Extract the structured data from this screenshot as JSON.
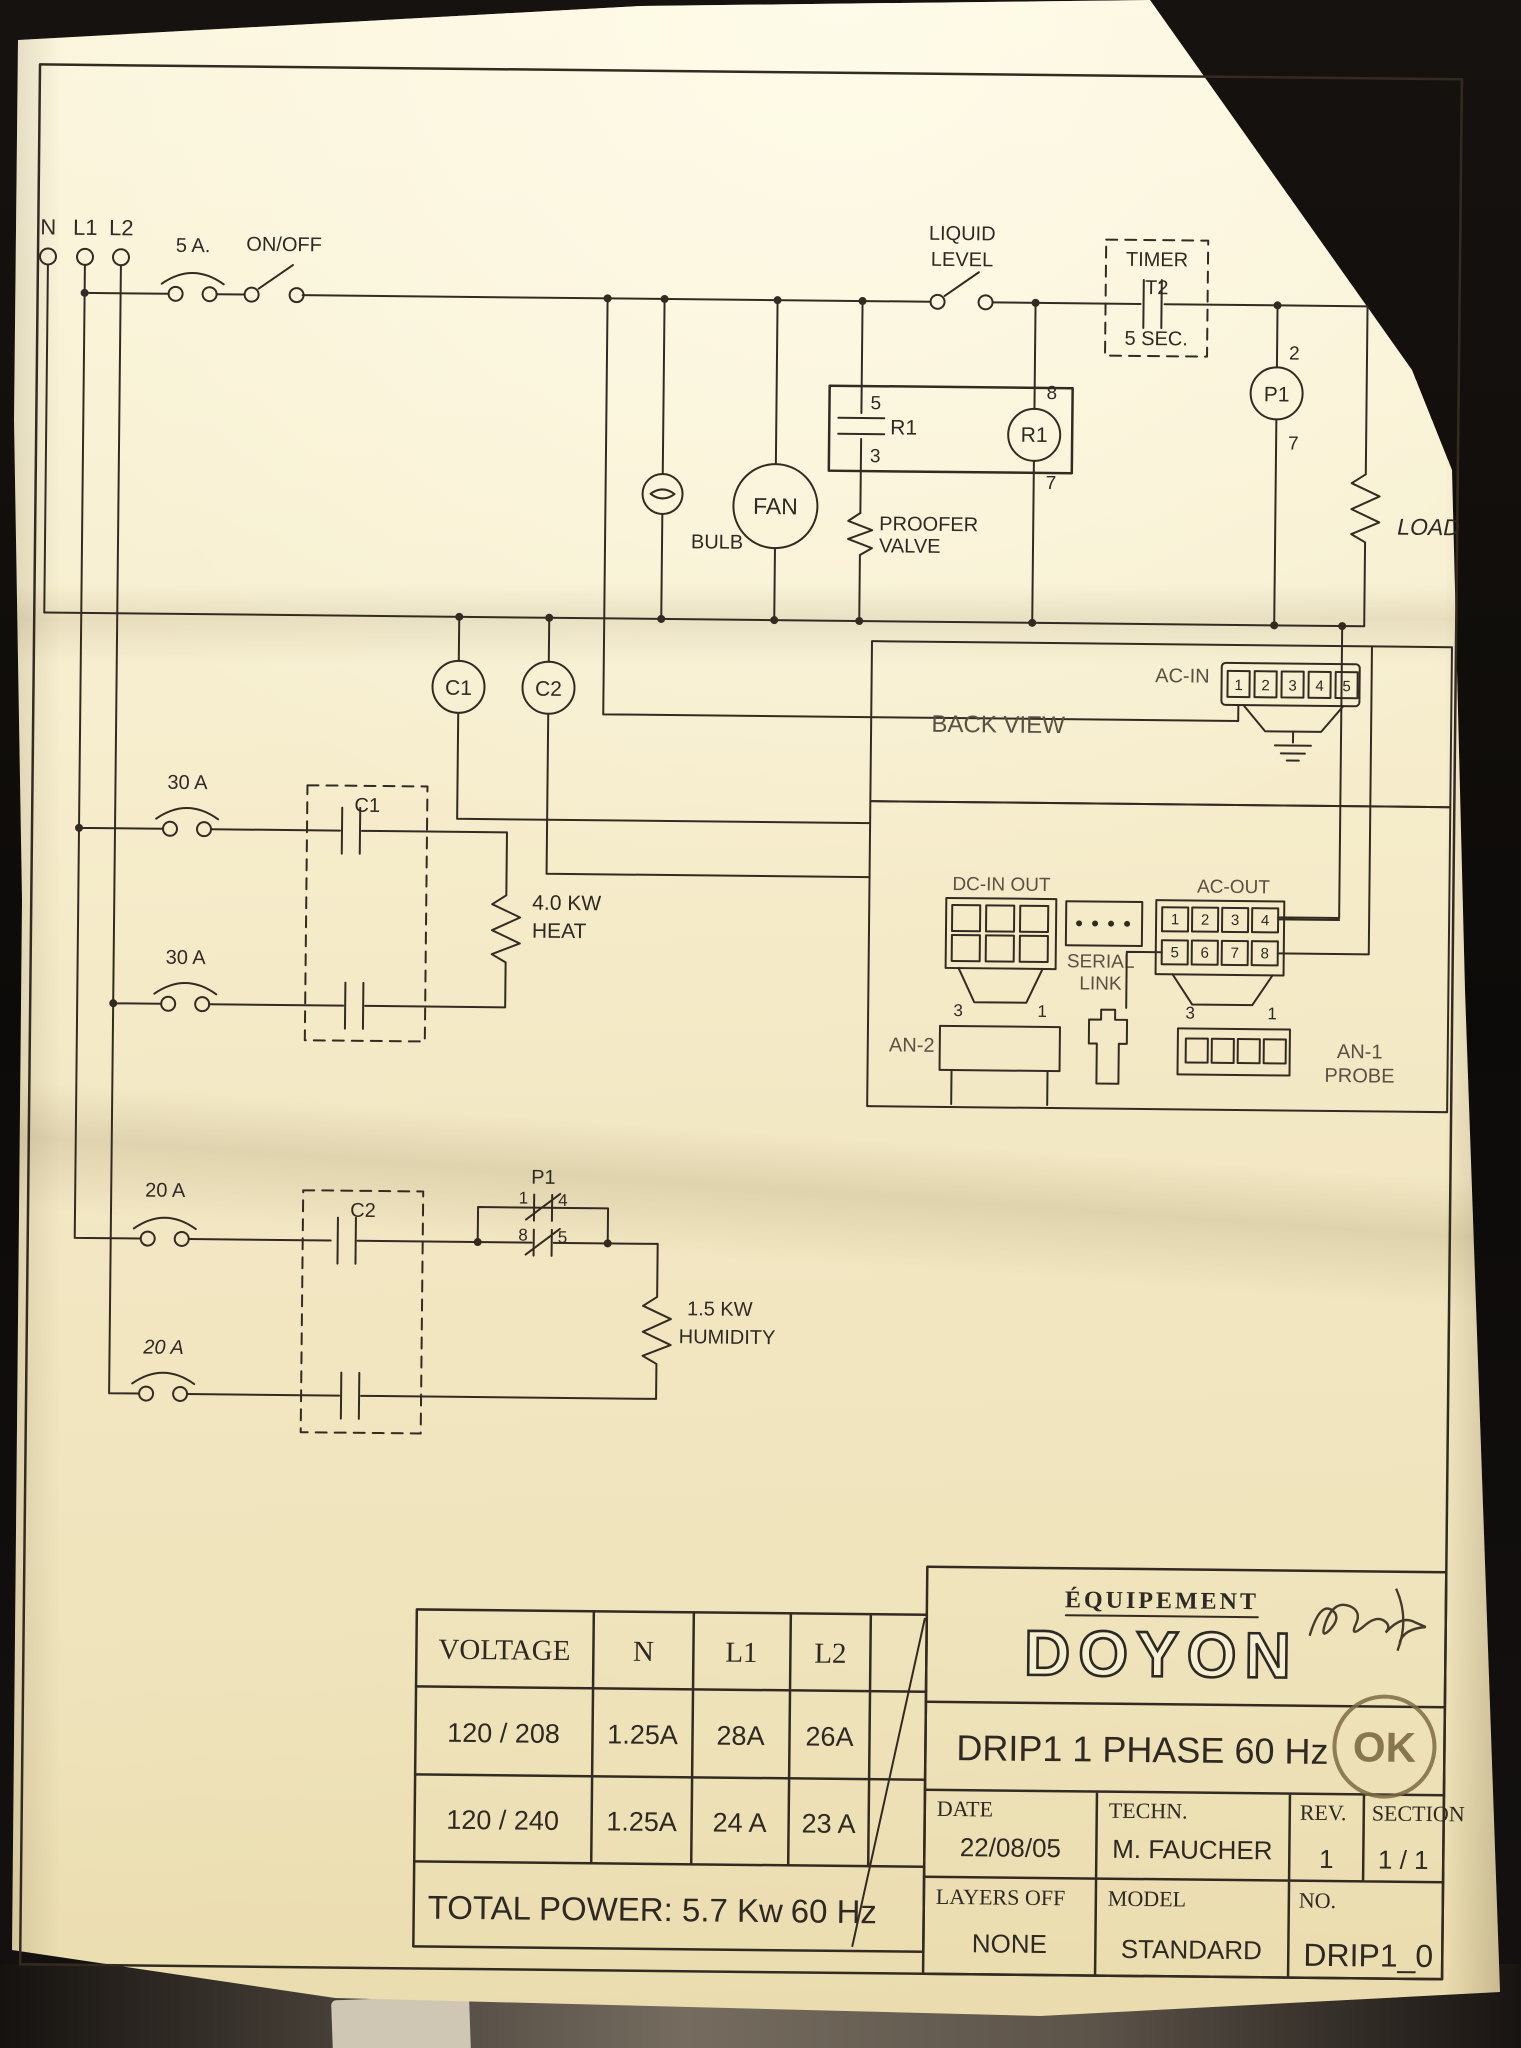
{
  "terminals": {
    "n": "N",
    "l1": "L1",
    "l2": "L2"
  },
  "main": {
    "fuse_label": "5 A.",
    "switch_label": "ON/OFF",
    "liquid_line1": "LIQUID",
    "liquid_line2": "LEVEL",
    "timer_line1": "TIMER",
    "timer_line2": "T2",
    "timer_line3": "5 SEC.",
    "bulb_label": "BULB",
    "fan_label": "FAN",
    "r1_contact": {
      "pin_top": "5",
      "name": "R1",
      "pin_bottom": "3"
    },
    "valve_line1": "PROOFER",
    "valve_line2": "VALVE",
    "r1_coil": {
      "pin_top": "8",
      "name": "R1",
      "pin_bottom": "7"
    },
    "p1_coil": {
      "pin_top": "2",
      "name": "P1",
      "pin_bottom": "7"
    },
    "load_label": "LOAD",
    "c1_label": "C1",
    "c2_label": "C2"
  },
  "board": {
    "title": "BACK VIEW",
    "ac_in_label": "AC-IN",
    "ac_in_terminals": [
      "1",
      "2",
      "3",
      "4",
      "5"
    ],
    "dc_label": "DC-IN OUT",
    "serial_line1": "SERIAL",
    "serial_line2": "LINK",
    "ac_out_label": "AC-OUT",
    "ac_out_row1": [
      "1",
      "2",
      "3",
      "4"
    ],
    "ac_out_row2": [
      "5",
      "6",
      "7",
      "8"
    ],
    "an2_label": "AN-2",
    "an2_pin_left": "3",
    "an2_pin_right": "1",
    "an1_pin_left": "3",
    "an1_pin_right": "1",
    "an1_line1": "AN-1",
    "an1_line2": "PROBE"
  },
  "heat": {
    "fuse_top": "30 A",
    "fuse_bottom": "30 A",
    "box_label": "C1",
    "load_line1": "4.0 KW",
    "load_line2": "HEAT"
  },
  "humidity": {
    "fuse_top": "20 A",
    "fuse_bottom": "20 A",
    "box_label": "C2",
    "p1_name": "P1",
    "pin1": "1",
    "pin4": "4",
    "pin8": "8",
    "pin5": "5",
    "load_line1": "1.5 KW",
    "load_line2": "HUMIDITY"
  },
  "table": {
    "col_voltage": "VOLTAGE",
    "col_n": "N",
    "col_l1": "L1",
    "col_l2": "L2",
    "rows": [
      [
        "120 / 208",
        "1.25A",
        "28A",
        "26A"
      ],
      [
        "120 / 240",
        "1.25A",
        "24 A",
        "23 A"
      ]
    ],
    "footer_left": "TOTAL POWER: 5.7 Kw",
    "footer_right": "60 Hz"
  },
  "title_block": {
    "equipment": "ÉQUIPEMENT",
    "brand": "DOYON",
    "stamp": "OK",
    "drawing_title": "DRIP1  1 PHASE 60 Hz",
    "date_label": "DATE",
    "date_value": "22/08/05",
    "techn_label": "TECHN.",
    "techn_value": "M. FAUCHER",
    "rev_label": "REV.",
    "rev_value": "1",
    "section_label": "SECTION",
    "section_value": "1 / 1",
    "layers_label": "LAYERS  OFF",
    "layers_value": "NONE",
    "model_label": "MODEL",
    "model_value": "STANDARD",
    "no_label": "NO.",
    "no_value": "DRIP1_0"
  }
}
